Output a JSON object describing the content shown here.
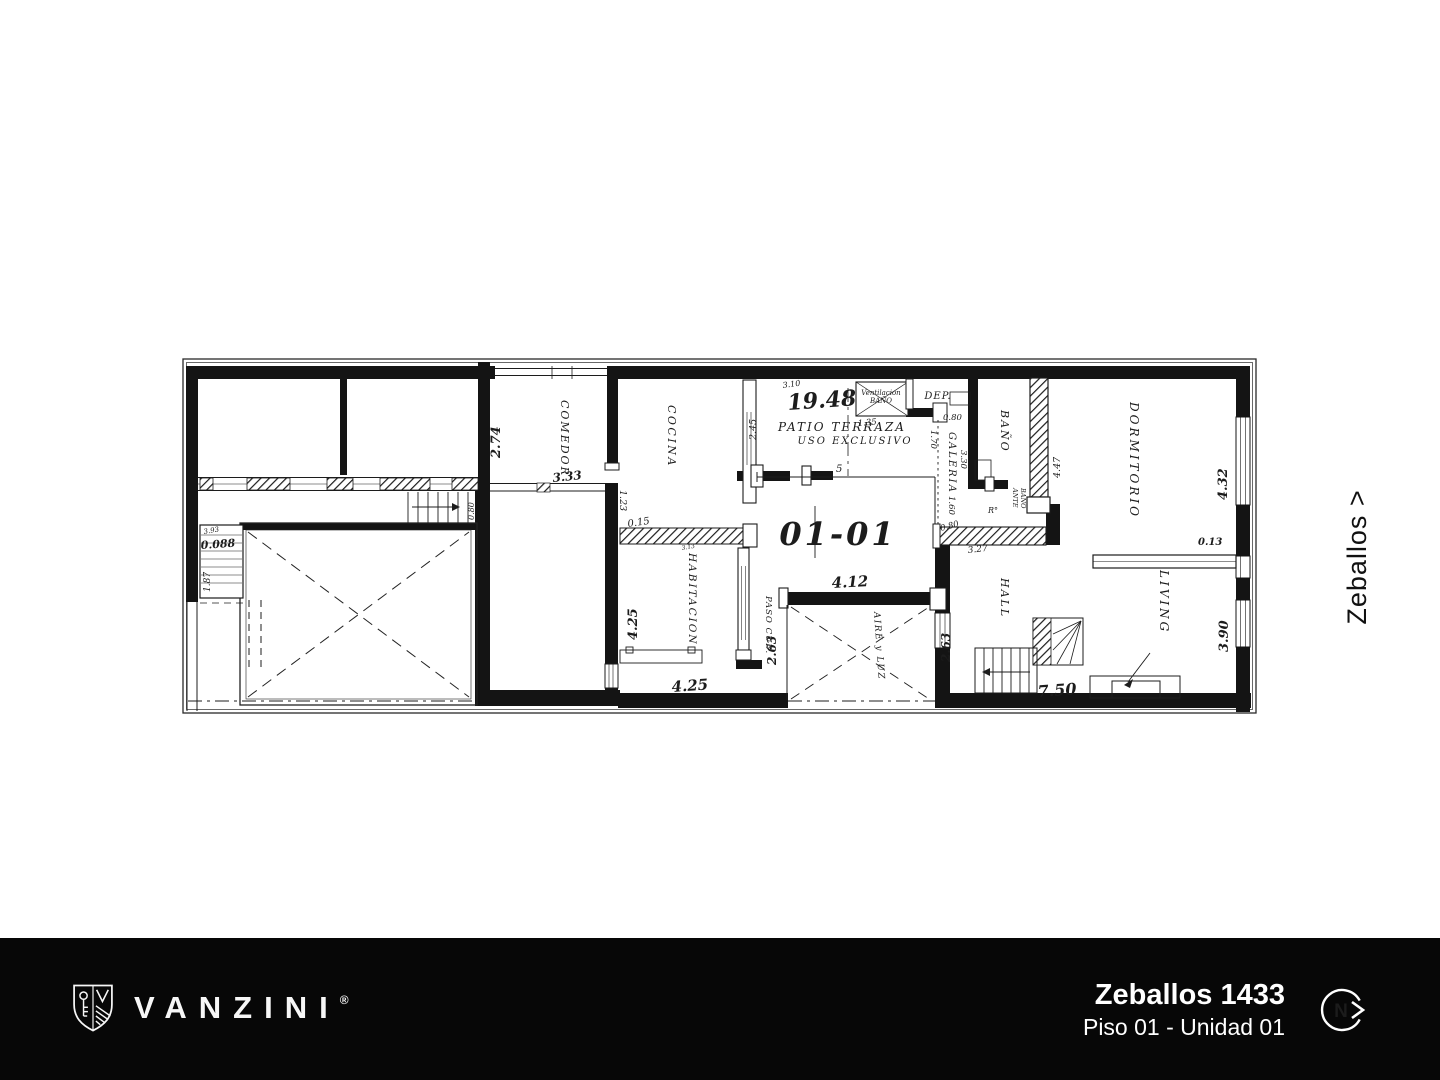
{
  "street": {
    "label": "Zeballos >"
  },
  "footer": {
    "brand": "VANZINI",
    "registered": "®",
    "address": "Zeballos 1433",
    "unit": "Piso 01 - Unidad 01",
    "north_letter": "N",
    "bg": "#070707",
    "text_color": "#ffffff"
  },
  "plan": {
    "ink_color": "#1c1c1c",
    "unit_number": "01-01",
    "labels": {
      "comedor": "COMEDOR",
      "cocina": "COCINA",
      "patio_line1": "PATIO TERRAZA",
      "patio_line2": "USO EXCLUSIVO",
      "vent_line1": "Ventilacion",
      "vent_line2": "BAÑO",
      "dep": "DEP.",
      "galeria": "GALERIA",
      "bano": "BAÑO",
      "ante_line1": "ANTE",
      "ante_line2": "BAÑO",
      "ro": "R°",
      "dormitorio": "DORMITORIO",
      "habitacion": "HABITACION",
      "paso_cub": "PASO CUB.",
      "aire_y_luz": "AIRE y LUZ",
      "hall": "HALL",
      "living": "LIVING"
    },
    "dims": {
      "total": "19.48",
      "d310": "3.10",
      "d274": "2.74",
      "d333": "3.33",
      "d123": "1.23",
      "d015": "0.15",
      "d245": "2.45",
      "d135": "1.35",
      "d080_dep": "0.80",
      "d170": "1.70",
      "d330": "3.30",
      "d160": "1.60",
      "d080_gal": "0.80",
      "d327": "3.27",
      "d447": "4.47",
      "d432": "4.32",
      "d013": "0.13",
      "d390": "3.90",
      "d425v": "4.25",
      "d425h": "4.25",
      "d263l": "2.63",
      "d263r": "2.63",
      "d412": "4.12",
      "d750": "7.50",
      "d5": "5",
      "d080_stair": "0.80",
      "d313": "3.13",
      "d0088": "0.088",
      "d187": "1.87",
      "d393": "3.93"
    }
  }
}
